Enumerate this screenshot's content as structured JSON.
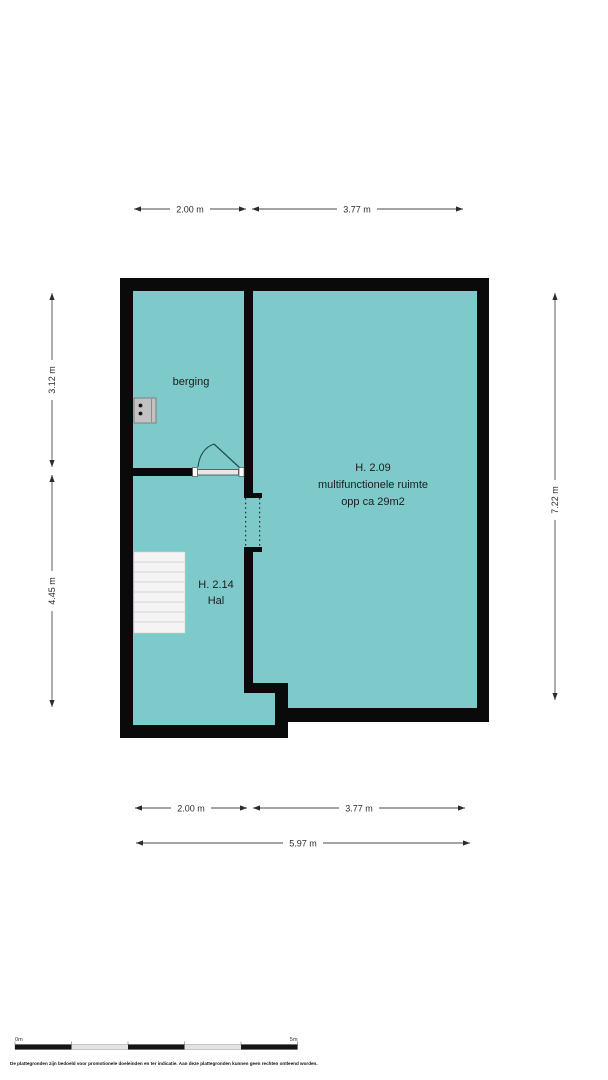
{
  "rooms": {
    "berging": {
      "label": "berging"
    },
    "multi": {
      "code": "H. 2.09",
      "name": "multifunctionele ruimte",
      "area": "opp ca 29m2"
    },
    "hal": {
      "code": "H. 2.14",
      "name": "Hal"
    }
  },
  "dimensions": {
    "top": [
      "2.00 m",
      "3.77 m"
    ],
    "left": [
      "3.12 m",
      "4.45 m"
    ],
    "right": [
      "7.22 m"
    ],
    "bottom": [
      "2.00 m",
      "3.77 m"
    ],
    "total_width": "5.97 m"
  },
  "scale_bar": {
    "start": "0m",
    "end": "5m"
  },
  "disclaimer": "De plattegronden zijn bedoeld voor promotionele doeleinden en ter indicatie. Aan deze plattegronden kunnen geen rechten ontleend worden.",
  "colors": {
    "floor": "#7ecaca",
    "wall": "#0a0a0a",
    "stairs": "#f4f4f4"
  }
}
